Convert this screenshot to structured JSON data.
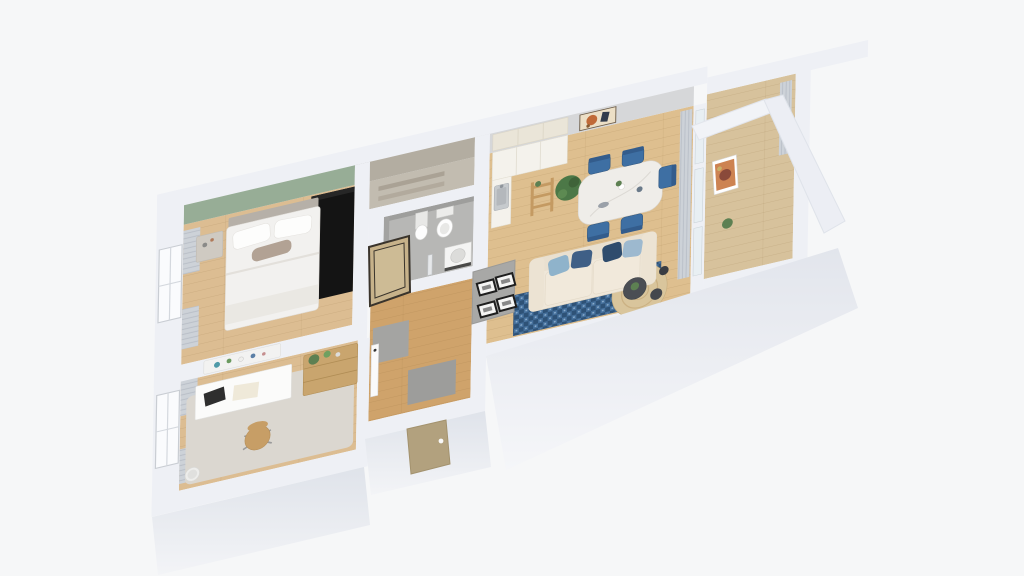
{
  "scene": {
    "title": "apartment-3d-floor-plan",
    "view": "axonometric-top-down",
    "background": "#f6f7f8"
  },
  "palette": {
    "wall_top": "#eef0f5",
    "wall_gray": "#a8a8a6",
    "green_wall": "#97ad96",
    "closet_face": "#b3ada1",
    "living_face": "#d6d7d9",
    "wood_bedroom": "#dcbd92",
    "wood_hall": "#cfa36b",
    "wood_living": "#debf8f",
    "wood_balcony": "#d7c29c",
    "bathroom_floor": "#b7b7b5",
    "closet_floor": "#c2bcb0",
    "office_rug": "#dbd7d0",
    "wardrobe_black": "#141414",
    "bed_white": "#f2f1ef",
    "headboard": "#b6b0a8",
    "accent_pillow": "#b2a294",
    "nightstand": "#cfcac2",
    "desk_white": "#fbfbfa",
    "dresser_wood": "#c9a56e",
    "chair_wood": "#c79e66",
    "kitchen_cabinet": "#f4f2ec",
    "kitchen_upper": "#eae5d8",
    "steel_sink": "#c6cacd",
    "ladder_wood": "#c49a62",
    "plant_green": "#4c7847",
    "table_marble": "#efede9",
    "chair_blue": "#3e6fa3",
    "sofa_cream": "#efe7d9",
    "pillow_light_blue": "#8fb3cb",
    "pillow_navy": "#3f5f86",
    "rug_blue": "#46719d",
    "rug_blue_dark": "#2e5277",
    "jute_rug": "#d9c59c",
    "coffee_table_dark": "#4b4e54",
    "curtain": "#cdd2d8",
    "door_entrance": "#b2a17e",
    "door_mirror": "#c7b28a",
    "art_cream": "#ecdfc6",
    "art_terracotta": "#c06a38",
    "glass": "#e8eff3",
    "gray_mat": "#9d9d9b"
  },
  "rooms": [
    {
      "id": "bedroom",
      "features": [
        "green-accent-wall",
        "double-bed",
        "white-duvet",
        "two-pillows",
        "taupe-accent-pillow",
        "nightstand",
        "black-wardrobe",
        "window-with-curtains"
      ]
    },
    {
      "id": "home-office",
      "features": [
        "white-desk",
        "laptop",
        "office-chair",
        "wooden-dresser",
        "plants",
        "wall-shelf-with-decor",
        "light-area-rug",
        "window-with-curtains",
        "waste-bin"
      ]
    },
    {
      "id": "hallway",
      "features": [
        "entrance-door",
        "mirror-door",
        "open-white-door",
        "gallery-wall-four-frames",
        "gray-doormats"
      ]
    },
    {
      "id": "bathroom",
      "features": [
        "toilet",
        "pedestal-sink",
        "washing-machine",
        "towel-radiator",
        "gray-floor"
      ]
    },
    {
      "id": "closet-niche",
      "features": [
        "storage-shelves"
      ]
    },
    {
      "id": "living-room-kitchen",
      "features": [
        "kitchen-counter",
        "steel-sink",
        "upper-cabinets",
        "ladder-shelf",
        "large-potted-plant",
        "terracotta-wall-art",
        "marble-dining-table",
        "five-blue-chairs",
        "cream-boucle-sofa",
        "blue-throw-pillows",
        "checkered-blue-rug",
        "round-jute-rug",
        "dark-coffee-tables",
        "floor-length-curtains"
      ]
    },
    {
      "id": "balcony",
      "features": [
        "glazed-partition",
        "leaning-artwork",
        "curtain",
        "white-parapet-walls"
      ]
    }
  ]
}
